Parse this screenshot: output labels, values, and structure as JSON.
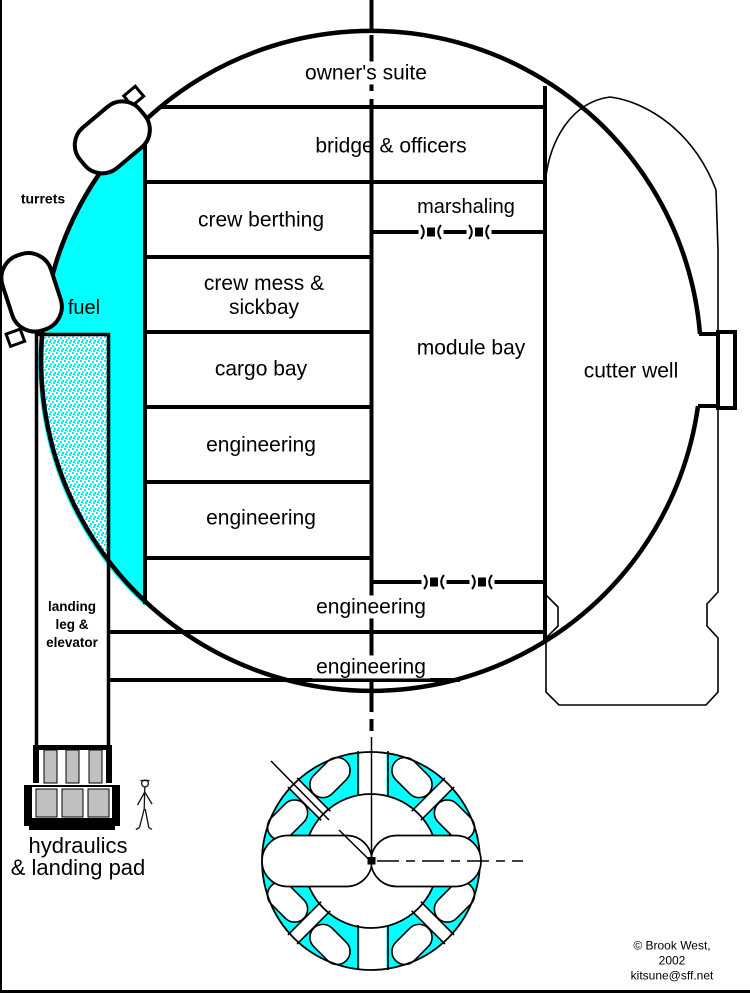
{
  "diagram": {
    "compartments": {
      "owners_suite": "owner's suite",
      "bridge_officers": "bridge & officers",
      "crew_berthing": "crew berthing",
      "marshaling": "marshaling",
      "crew_mess_line1": "crew mess &",
      "crew_mess_line2": "sickbay",
      "cargo_bay": "cargo bay",
      "module_bay": "module bay",
      "cutter_well": "cutter well",
      "engineering_upper": "engineering",
      "engineering_lower": "engineering",
      "engineering_wide_upper": "engineering",
      "engineering_wide_lower": "engineering"
    },
    "annotations": {
      "turrets": "turrets",
      "fuel": "fuel",
      "landing_leg_line1": "landing",
      "landing_leg_line2": "leg &",
      "landing_leg_line3": "elevator",
      "hydraulics_line1": "hydraulics",
      "hydraulics_line2": "& landing pad"
    },
    "credit": {
      "line1": "© Brook West, 2002",
      "line2": "kitsune@sff.net"
    },
    "colors": {
      "fuel_fill": "#00ffff",
      "outline": "#000000",
      "metal": "#c0c0c0",
      "background": "#ffffff"
    }
  }
}
